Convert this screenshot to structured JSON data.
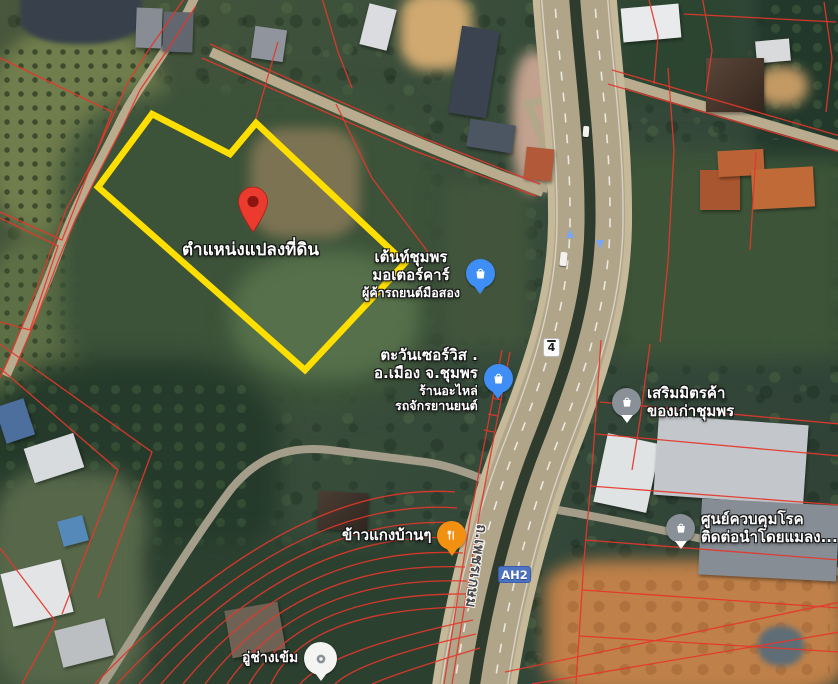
{
  "map_type": "satellite",
  "parcel": {
    "label": "ตำแหน่งแปลงที่ดิน",
    "outline_color": "#ffdf00",
    "pin_color": "#ea3b2e"
  },
  "road": {
    "shield": "4",
    "route_badge": "AH2",
    "name": "ถ.เพชรเกษม"
  },
  "pois": {
    "tent_chumphon": {
      "line1": "เต้นท์ชุมพร",
      "line2": "มอเตอร์คาร์",
      "sub1": "ผู้ค้ารถยนต์มือสอง",
      "icon": "shopping-bag",
      "icon_color": "#3f8ef6"
    },
    "tawan_service": {
      "line1": "ตะวันเซอร์วิส .",
      "line2": "อ.เมือง จ.ชุมพร",
      "sub1": "ร้านอะไหล่",
      "sub2": "รถจักรยานยนต์",
      "icon": "shopping-bag",
      "icon_color": "#3f8ef6"
    },
    "serm_mit": {
      "line1": "เสริมมิตรค้า",
      "line2": "ของเก่าชุมพร",
      "icon": "store",
      "icon_color": "#8a9097"
    },
    "disease_control": {
      "line1": "ศูนย์ควบคุมโรค",
      "line2": "ติดต่อนำโดยแมลง...",
      "icon": "store",
      "icon_color": "#8a9097"
    },
    "khao_gaeng": {
      "line1": "ข้าวแกงบ้านๆ",
      "icon": "restaurant",
      "icon_color": "#f29111"
    },
    "au_chang_khem": {
      "line1": "อู่ช่างเข้ม",
      "icon": "car-repair",
      "icon_color": "#f4f4f2"
    }
  },
  "colors": {
    "cadastral_line": "#e5372b",
    "parcel_outline": "#ffdf00",
    "pin": "#ea3b2e",
    "route_badge_bg": "#4d74c4",
    "highway_surface": "#b0a489"
  }
}
